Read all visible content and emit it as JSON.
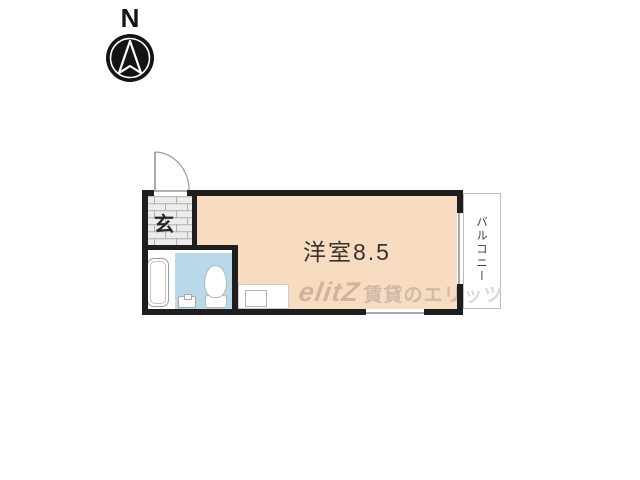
{
  "compass": {
    "label": "N"
  },
  "floor_plan": {
    "entrance": {
      "label": "玄"
    },
    "main_room": {
      "label": "洋室8.5"
    },
    "balcony": {
      "label": "バルコニー"
    }
  },
  "watermark": {
    "logo": "elitZ",
    "text": "賃貸のエリ",
    "tail": "ッツ"
  },
  "colors": {
    "wall": "#1e1e1e",
    "main_room_fill": "#f8dcc2",
    "bath_wet_fill": "#b9d9eb",
    "entrance_tile": "#ececea",
    "tile_line": "#b0b0aa",
    "label_text": "#3a332d",
    "watermark_brown": "#ccb6a4",
    "watermark_gray": "#d8d8d8"
  }
}
